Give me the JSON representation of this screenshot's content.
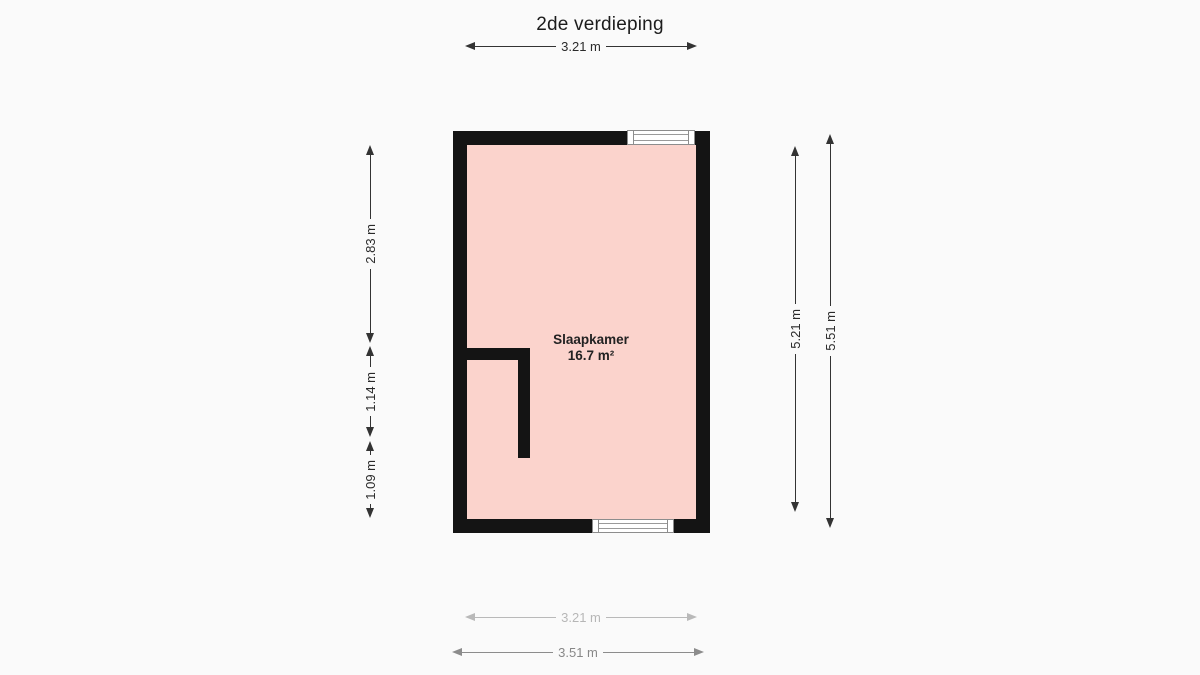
{
  "title": "2de verdieping",
  "room": {
    "name": "Slaapkamer",
    "area": "16.7 m²"
  },
  "dimensions": {
    "top_width": "3.21 m",
    "left_upper": "2.83 m",
    "left_middle": "1.14 m",
    "left_lower": "1.09 m",
    "right_inner": "5.21 m",
    "right_outer": "5.51 m",
    "bottom_inner": "3.21 m",
    "bottom_outer": "3.51 m"
  },
  "colors": {
    "background": "#fafafa",
    "wall": "#141414",
    "room_fill": "#fbd3cc",
    "dimension": "#333333"
  }
}
